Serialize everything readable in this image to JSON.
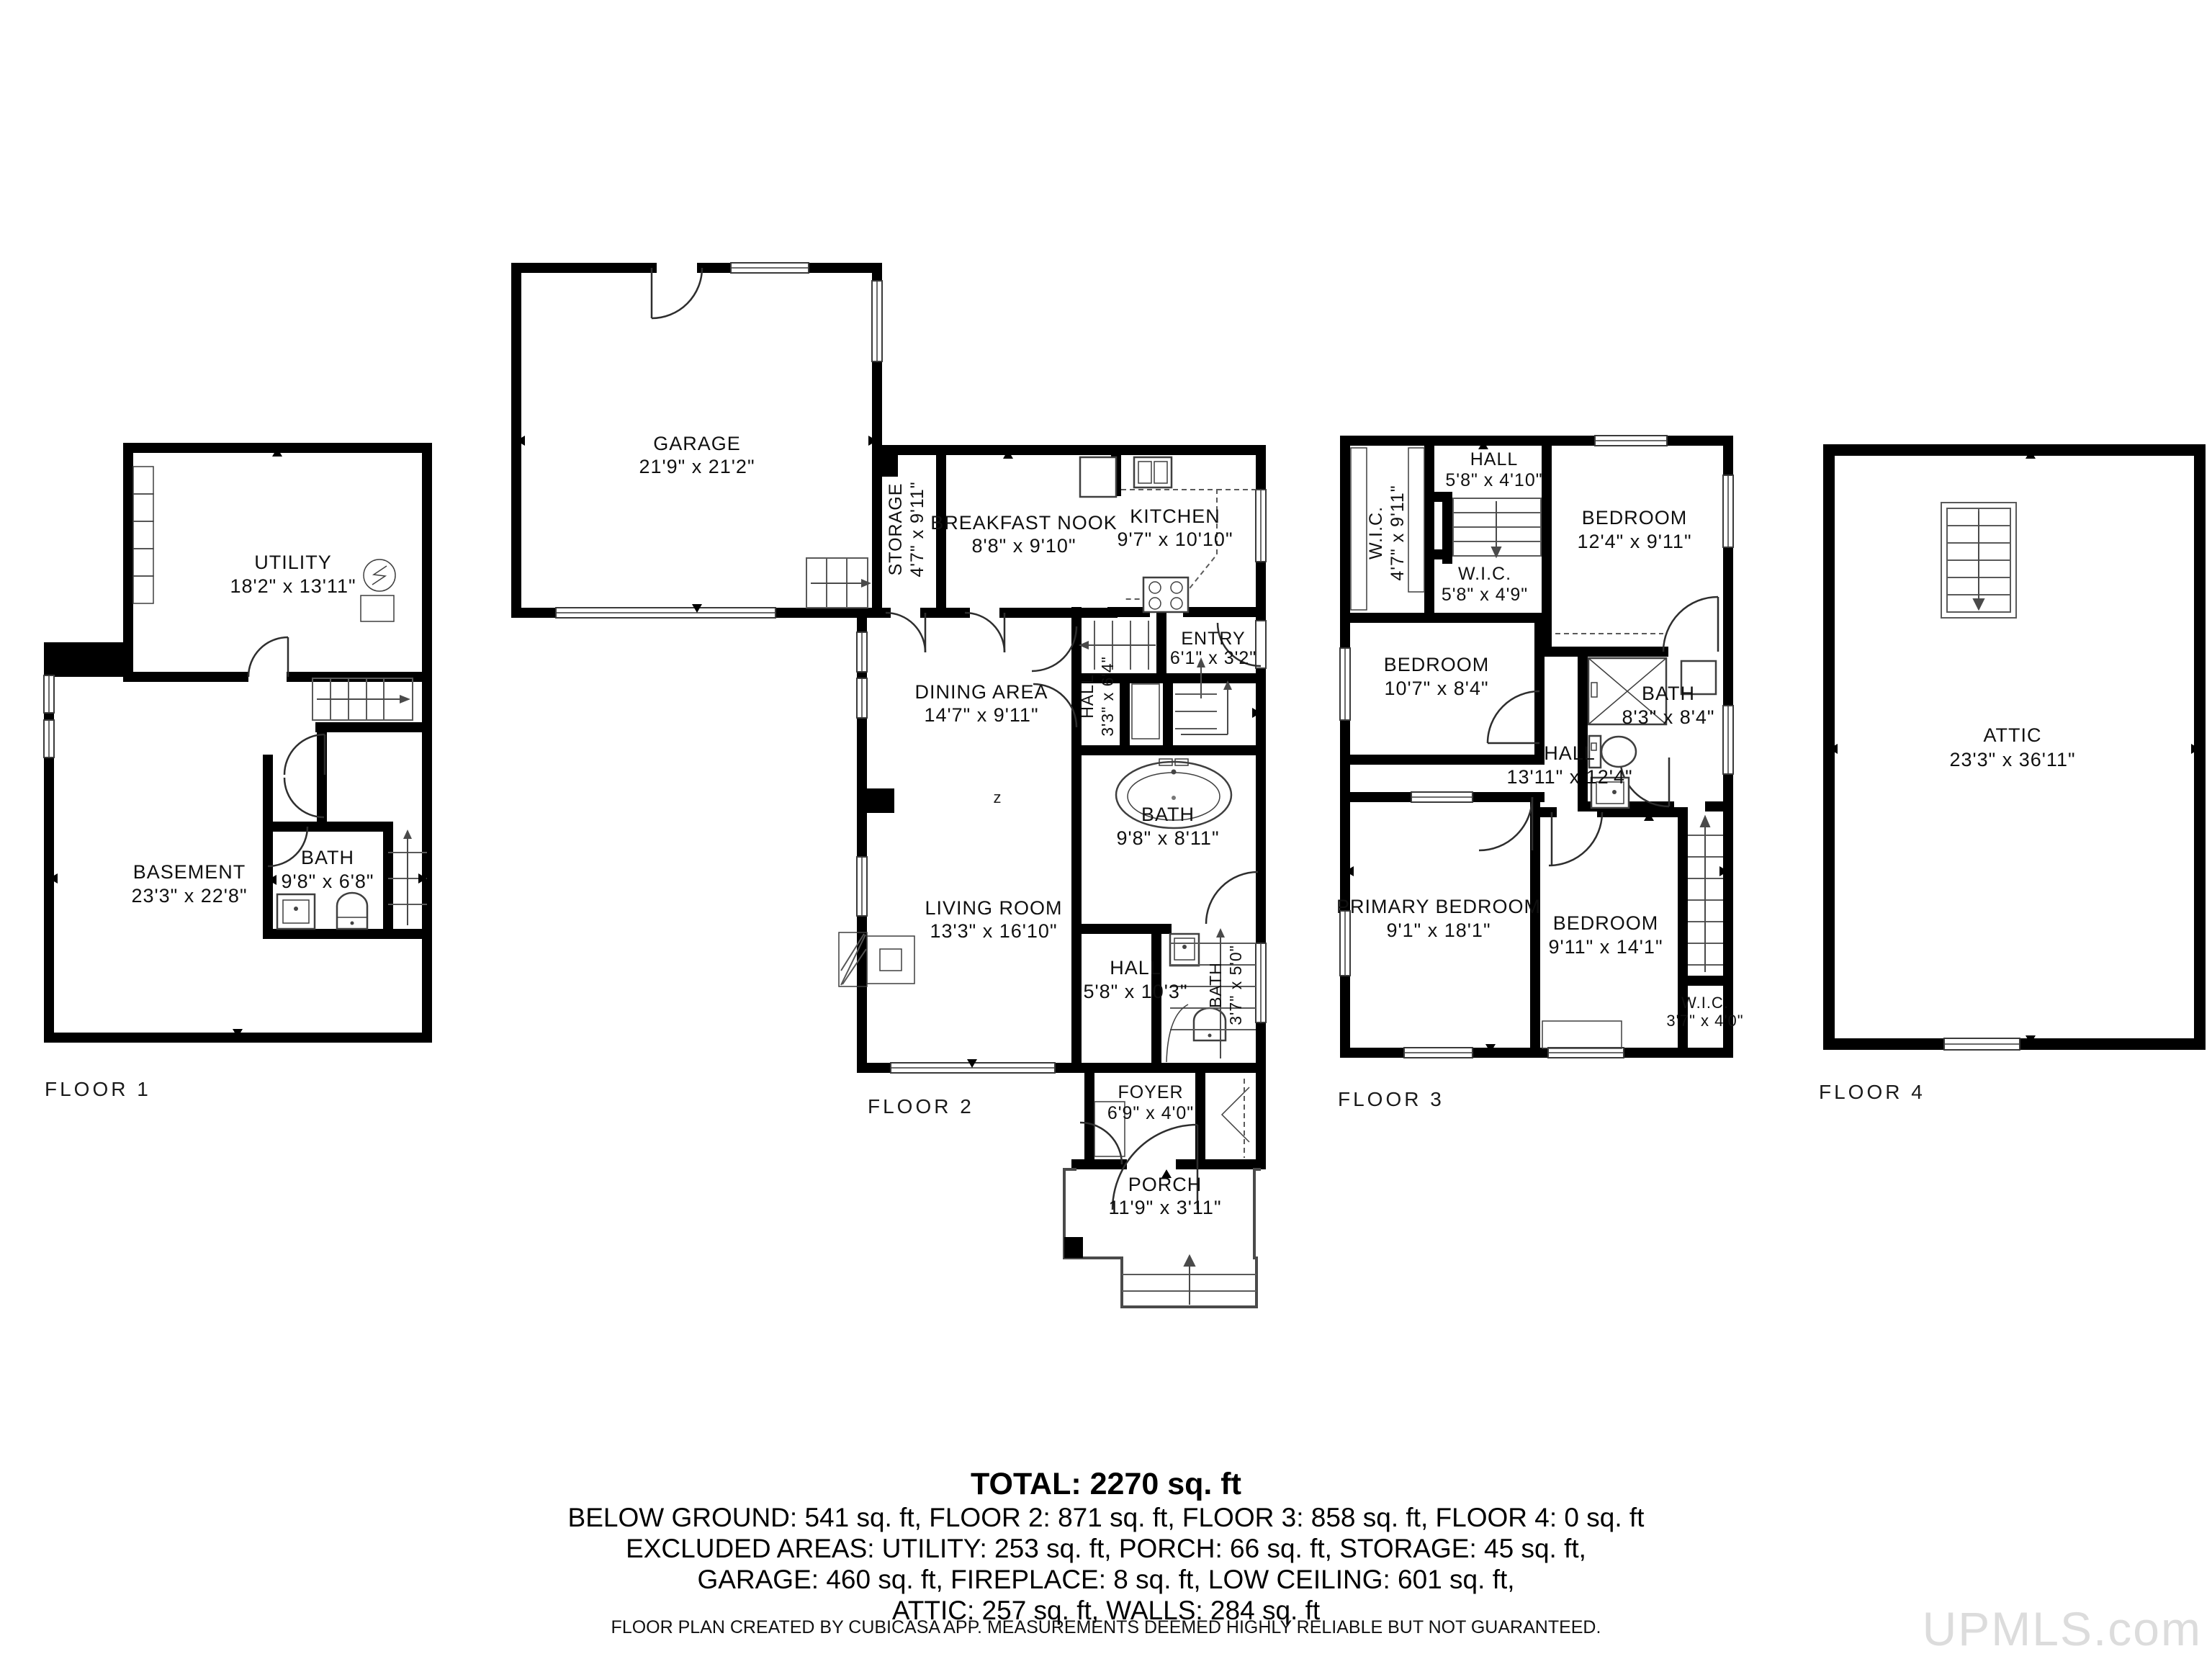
{
  "floors": [
    {
      "label": "FLOOR 1",
      "rooms": {
        "utility": {
          "name": "UTILITY",
          "dims": "18'2\" x 13'11\""
        },
        "basement": {
          "name": "BASEMENT",
          "dims": "23'3\" x 22'8\""
        },
        "bath": {
          "name": "BATH",
          "dims": "9'8\" x 6'8\""
        }
      }
    },
    {
      "label": "FLOOR 2",
      "rooms": {
        "garage": {
          "name": "GARAGE",
          "dims": "21'9\" x 21'2\""
        },
        "storage": {
          "name": "STORAGE",
          "dims": "4'7\" x 9'11\""
        },
        "breakfast_nook": {
          "name": "BREAKFAST NOOK",
          "dims": "8'8\" x 9'10\""
        },
        "kitchen": {
          "name": "KITCHEN",
          "dims": "9'7\" x 10'10\""
        },
        "entry": {
          "name": "ENTRY",
          "dims": "6'1\" x 3'2\""
        },
        "hall_upper": {
          "name": "HALL",
          "dims": "3'3\" x 6'4\""
        },
        "dining": {
          "name": "DINING AREA",
          "dims": "14'7\" x 9'11\""
        },
        "bath": {
          "name": "BATH",
          "dims": "9'8\" x 8'11\""
        },
        "bath_small": {
          "name": "BATH",
          "dims": "3'7\" x 5'0\""
        },
        "living": {
          "name": "LIVING ROOM",
          "dims": "13'3\" x 16'10\""
        },
        "hall_lower": {
          "name": "HALL",
          "dims": "5'8\" x 10'3\""
        },
        "foyer": {
          "name": "FOYER",
          "dims": "6'9\" x 4'0\""
        },
        "porch": {
          "name": "PORCH",
          "dims": "11'9\" x 3'11\""
        }
      },
      "dining_marker": "z"
    },
    {
      "label": "FLOOR 3",
      "rooms": {
        "wic_left": {
          "name": "W.I.C.",
          "dims": "4'7\" x 9'11\""
        },
        "hall_top": {
          "name": "HALL",
          "dims": "5'8\" x 4'10\""
        },
        "wic_mid": {
          "name": "W.I.C.",
          "dims": "5'8\" x 4'9\""
        },
        "bedroom_tr": {
          "name": "BEDROOM",
          "dims": "12'4\" x 9'11\""
        },
        "bedroom_l": {
          "name": "BEDROOM",
          "dims": "10'7\" x 8'4\""
        },
        "bath": {
          "name": "BATH",
          "dims": "8'3\" x 8'4\""
        },
        "hall_main": {
          "name": "HALL",
          "dims": "13'11\" x 12'4\""
        },
        "primary": {
          "name": "PRIMARY BEDROOM",
          "dims": "9'1\" x 18'1\""
        },
        "bedroom_b": {
          "name": "BEDROOM",
          "dims": "9'11\" x 14'1\""
        },
        "wic_small": {
          "name": "W.I.C.",
          "dims": "3'7\" x 4'0\""
        }
      }
    },
    {
      "label": "FLOOR 4",
      "rooms": {
        "attic": {
          "name": "ATTIC",
          "dims": "23'3\" x 36'11\""
        }
      }
    }
  ],
  "summary": {
    "total": "TOTAL: 2270 sq. ft",
    "line1": "BELOW GROUND: 541 sq. ft, FLOOR 2: 871 sq. ft, FLOOR 3: 858 sq. ft, FLOOR 4: 0 sq. ft",
    "line2": "EXCLUDED AREAS: UTILITY: 253 sq. ft, PORCH: 66 sq. ft, STORAGE: 45 sq. ft,",
    "line3": "GARAGE: 460 sq. ft, FIREPLACE: 8 sq. ft, LOW CEILING: 601 sq. ft,",
    "line4": "ATTIC: 257 sq. ft, WALLS: 284 sq. ft"
  },
  "disclaimer": "FLOOR PLAN CREATED BY CUBICASA APP. MEASUREMENTS DEEMED HIGHLY RELIABLE BUT NOT GUARANTEED.",
  "watermark": "UPMLS.com"
}
